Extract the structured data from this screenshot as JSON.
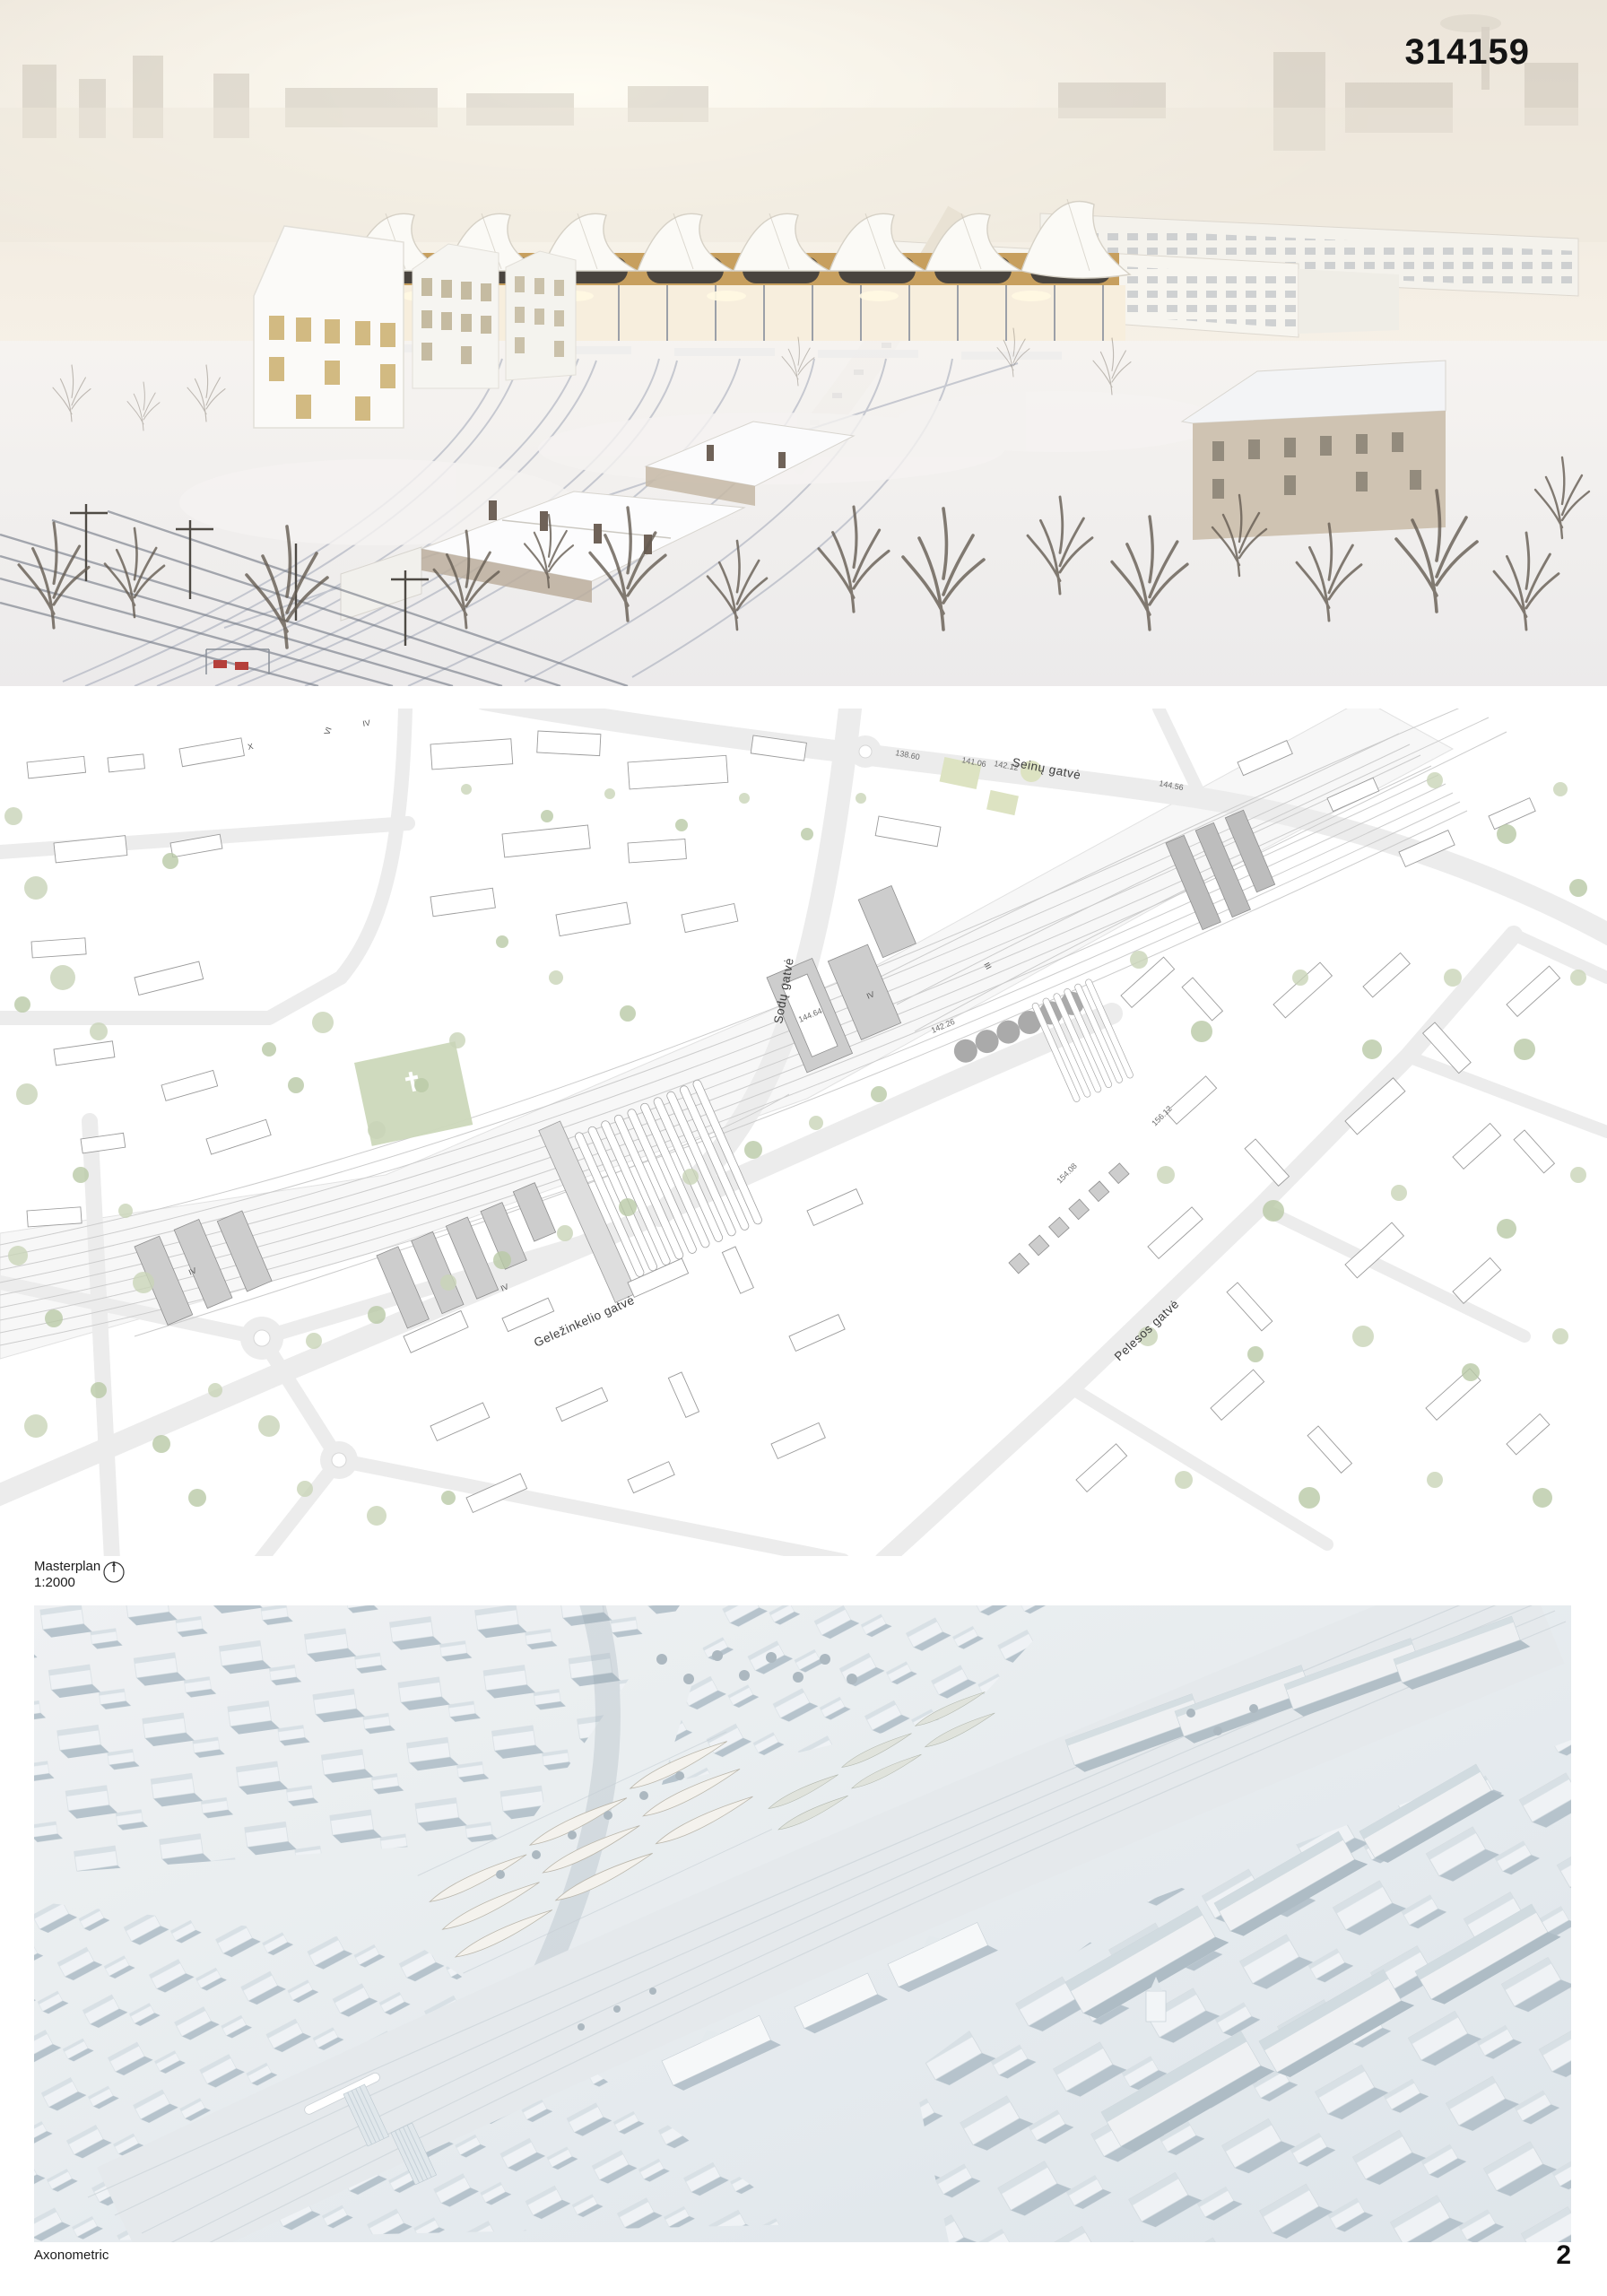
{
  "header": {
    "entry_number": "314159"
  },
  "masterplan": {
    "label": "Masterplan",
    "scale": "1:2000",
    "streets": {
      "seinu": "Seinų gatvė",
      "sodu": "Sodų gatvė",
      "gelezinkelio": "Geležinkelio gatvė",
      "pelesos": "Pelesos gatvė"
    },
    "elevations": [
      "138.60",
      "141.06",
      "142.12",
      "144.56",
      "144.64",
      "142.26",
      "154.08",
      "156.12"
    ],
    "floor_marks": [
      "X",
      "VI",
      "IV",
      "IV",
      "III",
      "IV",
      "IV"
    ]
  },
  "axonometric": {
    "label": "Axonometric"
  },
  "footer": {
    "page_number": "2"
  },
  "colors": {
    "tree_green": "#c9d4b8",
    "new_building_grey": "#cdcdcd",
    "model_blue_grey": "#b2c0c9",
    "wood_accent": "#c79f5e",
    "signal_red": "#b5403b"
  }
}
